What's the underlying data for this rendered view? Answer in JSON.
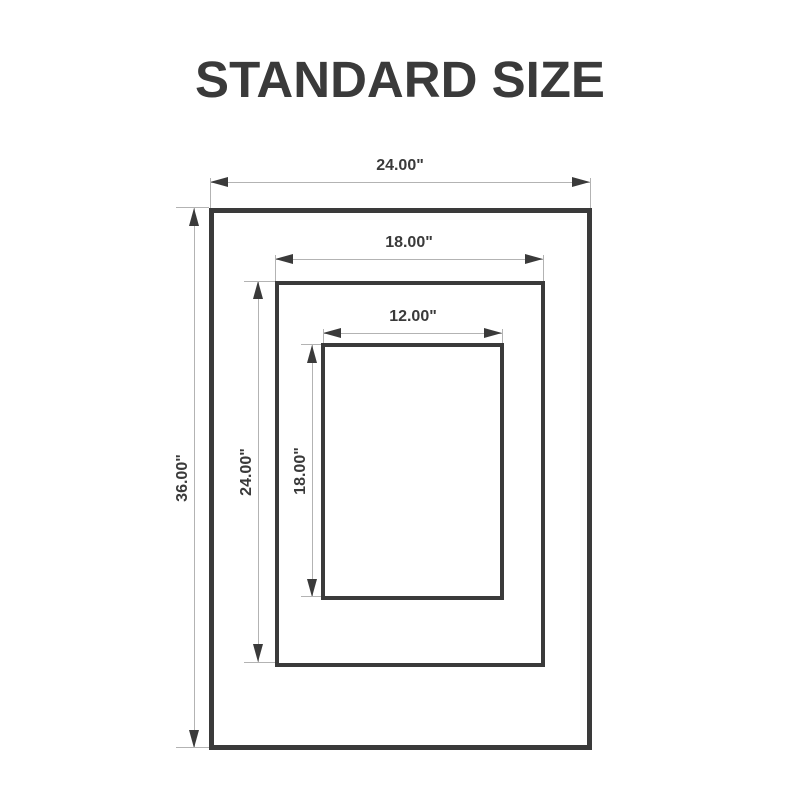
{
  "title": "STANDARD SIZE",
  "colors": {
    "frame": "#3a3a3a",
    "dimension_line": "#b3b3b3",
    "label_text": "#3a3a3a",
    "background": "#ffffff"
  },
  "frames": [
    {
      "id": "outer",
      "width_label": "24.00\"",
      "height_label": "36.00\""
    },
    {
      "id": "middle",
      "width_label": "18.00\"",
      "height_label": "24.00\""
    },
    {
      "id": "inner",
      "width_label": "12.00\"",
      "height_label": "18.00\""
    }
  ]
}
